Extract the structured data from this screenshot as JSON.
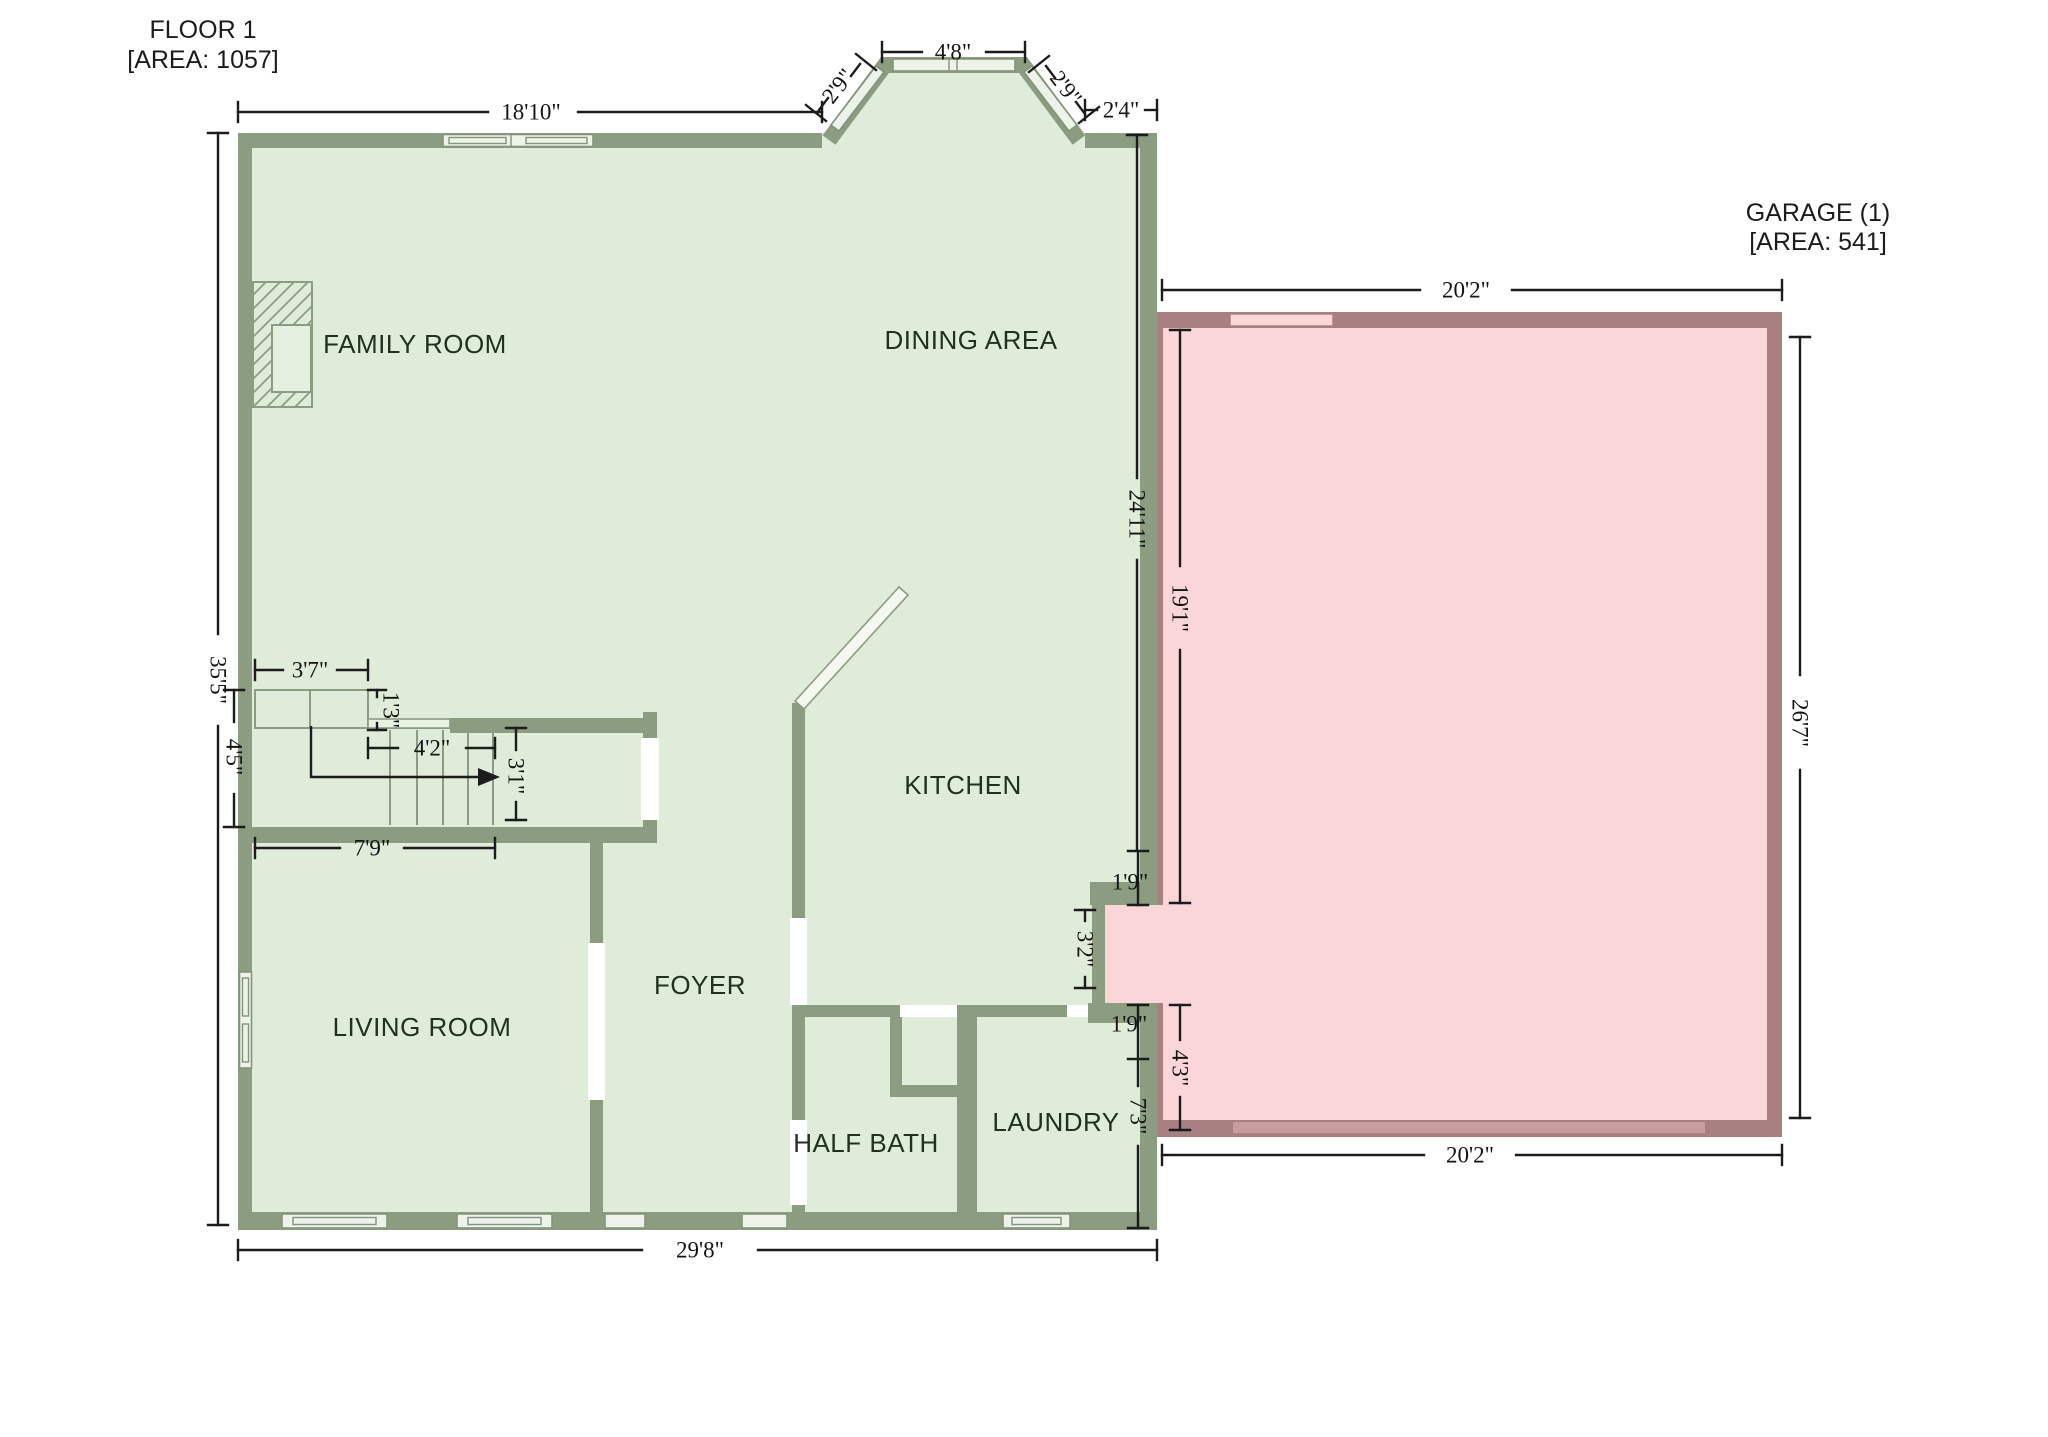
{
  "floor1": {
    "title": "FLOOR 1",
    "area": "[AREA: 1057]",
    "rooms": {
      "family_room": "FAMILY ROOM",
      "dining_area": "DINING AREA",
      "kitchen": "KITCHEN",
      "foyer": "FOYER",
      "living_room": "LIVING ROOM",
      "half_bath": "HALF BATH",
      "laundry": "LAUNDRY"
    }
  },
  "garage": {
    "title": "GARAGE (1)",
    "area": "[AREA: 541]"
  },
  "dims": {
    "top_wall": "18'10\"",
    "bay_top": "4'8\"",
    "bay_left": "2'9\"",
    "bay_right": "2'9\"",
    "top_right": "2'4\"",
    "floor_right": "24'11\"",
    "left_wall": "35'5\"",
    "bottom_wall": "29'8\"",
    "stair_landing": "3'7\"",
    "stair_rail": "1'3\"",
    "stair_run": "4'2\"",
    "stair_width": "3'1\"",
    "stair_wall": "7'9\"",
    "stair_height": "4'5\"",
    "door_above": "1'9\"",
    "door_opening": "3'2\"",
    "door_below": "1'9\"",
    "laundry_right": "7'3\"",
    "garage_top": "20'2\"",
    "garage_left": "19'1\"",
    "garage_right": "26'7\"",
    "garage_bottom": "20'2\"",
    "garage_door_side": "4'3\""
  },
  "colors": {
    "floor_fill": "#dfecda",
    "floor_wall": "#8b9c81",
    "garage_fill": "#fbd6d9",
    "garage_wall": "#a98082",
    "dimension": "#1c1c1c"
  }
}
